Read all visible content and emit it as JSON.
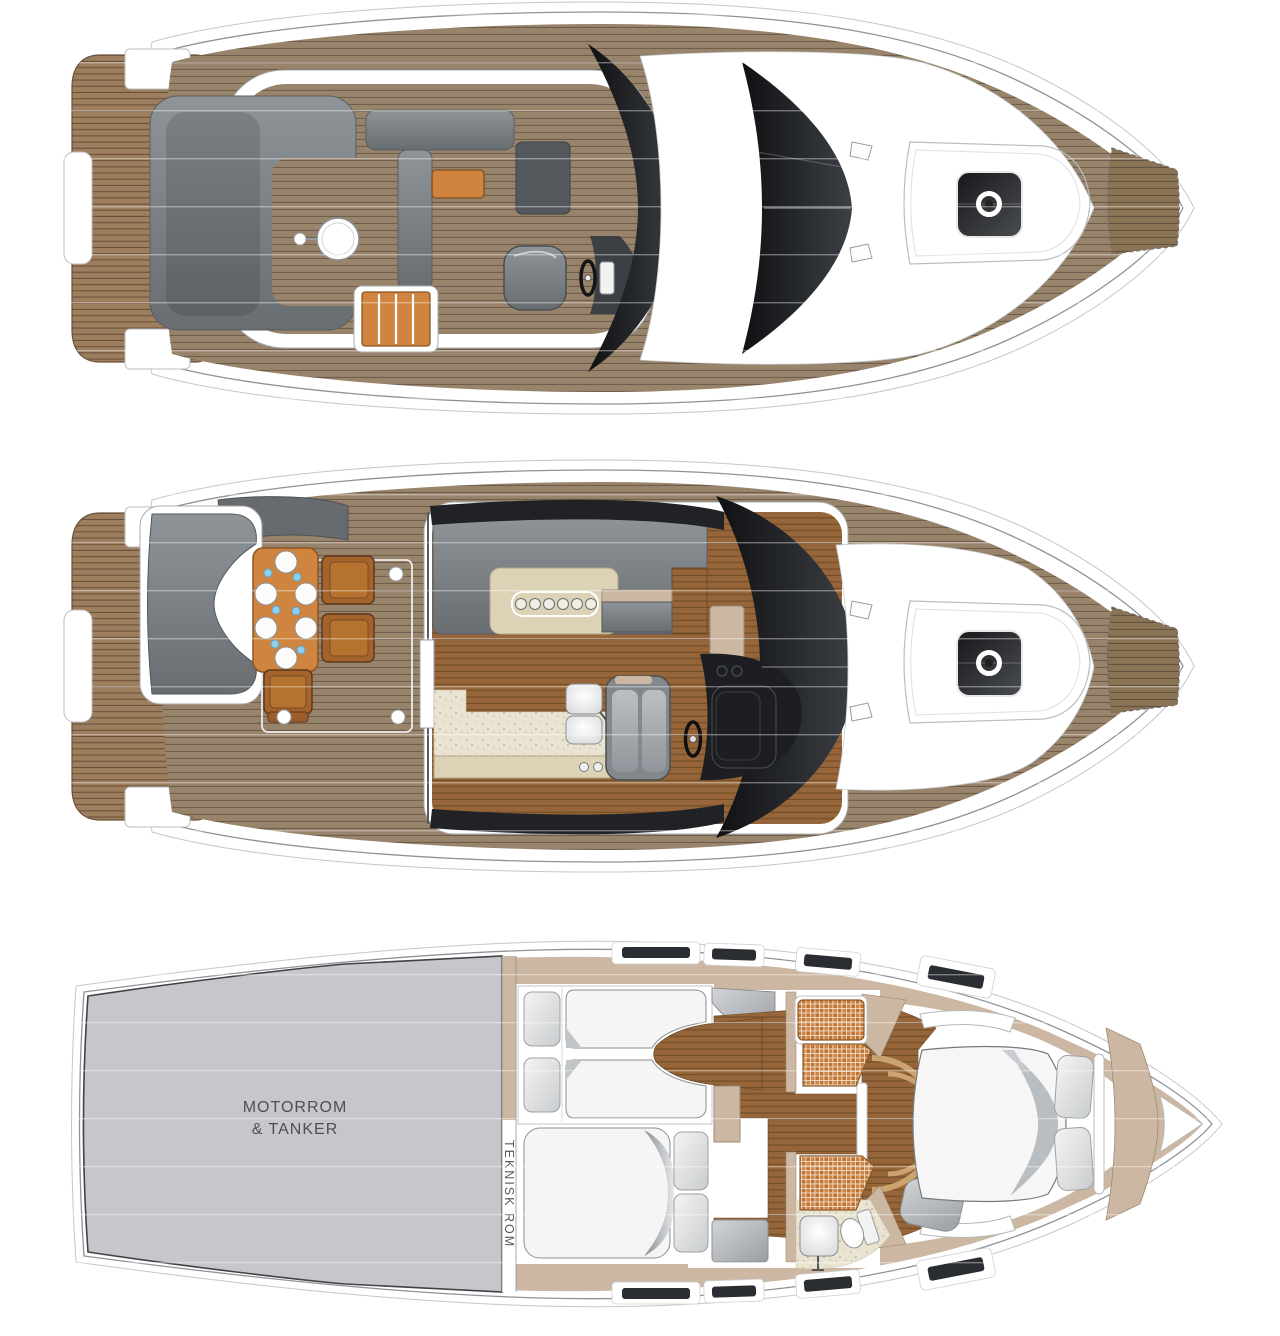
{
  "page": {
    "width": 1280,
    "height": 1336,
    "background": "#ffffff",
    "description": "Motor yacht floor plan drawing with three deck levels seen from above, bow pointing right"
  },
  "palette": {
    "teak_deck": "#98836b",
    "teak_stripe": "#6f5e4b",
    "swim_platform_teak": "#9d7f5f",
    "interior_wood_floor": "#96663a",
    "seating_gray": "#7e8387",
    "glass_black": "#17181a",
    "furniture_orange": "#cf8440",
    "wall_beige": "#cbb7a2",
    "floor_speckle_beige": "#e9e3d2",
    "counter_beige": "#dcd2b6",
    "engine_room_gray": "#c7c7cb",
    "bed_linen_white": "#f5f5f6",
    "label_gray": "#4f4f4f",
    "plate_glass_blue": "#8fd0ef",
    "hull_outline": "#8f9296"
  },
  "labels": {
    "engine_room_line1": "MOTORROM",
    "engine_room_line2": "& TANKER",
    "technical_room": "TEKNISK ROM"
  },
  "decks": [
    {
      "id": "flybridge-deck",
      "items": [
        "swim-platform",
        "aft-sun-lounge",
        "round-cocktail-table",
        "wet-bar-table",
        "sideboard",
        "stairs-hatch",
        "helm-seat",
        "steering-wheel",
        "flybridge-windscreen",
        "main-windshield",
        "foredeck-sunpad",
        "deck-hatch",
        "mooring-cleats",
        "anchor-locker"
      ]
    },
    {
      "id": "main-deck",
      "items": [
        "swim-platform",
        "transom-sofa",
        "cockpit-dining-table",
        "dining-plates",
        "deck-chairs",
        "sliding-door",
        "galley-counter",
        "stove-burners",
        "twin-sinks",
        "salon-settee",
        "helm-bench",
        "steering-wheel",
        "windshield-console",
        "foredeck-sunpad",
        "deck-hatch",
        "mooring-cleats",
        "anchor-locker"
      ]
    },
    {
      "id": "lower-deck",
      "engine_room_label": [
        "MOTORROM",
        "& TANKER"
      ],
      "technical_room_label": "TEKNISK ROM",
      "items": [
        "engine-room",
        "technical-room-corridor",
        "twin-guest-cabin",
        "single-beds",
        "double-guest-cabin",
        "double-bed",
        "shower-grates",
        "washbasin",
        "toilet",
        "corridor",
        "master-cabin",
        "island-bed",
        "pillows",
        "hull-windows",
        "bow-locker"
      ]
    }
  ]
}
